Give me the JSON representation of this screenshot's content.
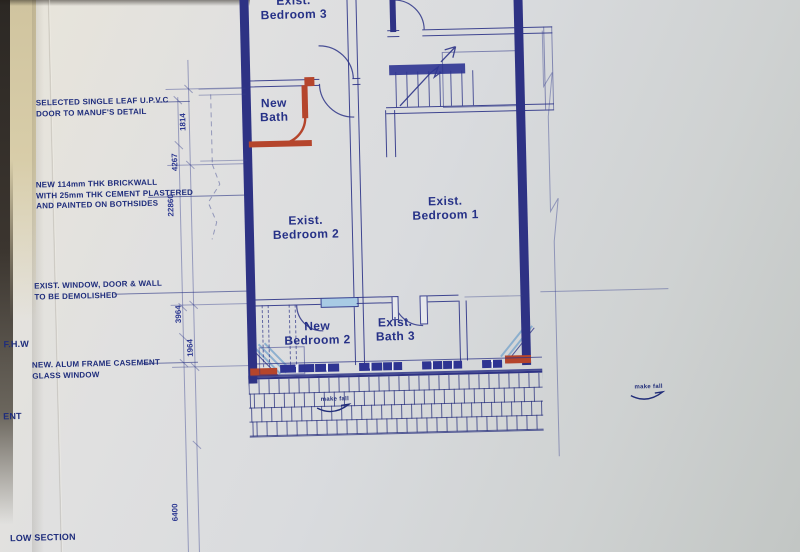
{
  "colors": {
    "ink": "#2b3187",
    "new_work": "#b5452c",
    "paper": "#d9dbdf",
    "glass": "#a8cbe4"
  },
  "annotations": {
    "upvc": {
      "line1": "SELECTED SINGLE LEAF U.P.V.C",
      "line2": "DOOR TO MANUF'S DETAIL"
    },
    "brickwall": {
      "line1": "NEW 114mm THK BRICKWALL",
      "line2": "WITH 25mm THK CEMENT PLASTERED",
      "line3": "AND PAINTED ON BOTHSIDES"
    },
    "demolish": {
      "line1": "EXIST. WINDOW, DOOR & WALL",
      "line2": "TO BE DEMOLISHED"
    },
    "fhw": "F.H.W",
    "casement": {
      "line1": "NEW. ALUM FRAME CASEMENT",
      "line2": "GLASS WINDOW"
    },
    "edge_partial": "ENT",
    "section": "LOW SECTION"
  },
  "rooms": [
    {
      "id": "exist-bedroom-3",
      "line1": "Exist.",
      "line2": "Bedroom 3"
    },
    {
      "id": "new-bath",
      "line1": "New",
      "line2": "Bath"
    },
    {
      "id": "exist-bedroom-2",
      "line1": "Exist.",
      "line2": "Bedroom 2"
    },
    {
      "id": "exist-bedroom-1",
      "line1": "Exist.",
      "line2": "Bedroom 1"
    },
    {
      "id": "new-bedroom-2",
      "line1": "New",
      "line2": "Bedroom 2"
    },
    {
      "id": "exist-bath-3",
      "line1": "Exist.",
      "line2": "Bath 3"
    }
  ],
  "dimensions": [
    "1814",
    "4267",
    "22860",
    "3964",
    "1964",
    "6400"
  ],
  "hatch_labels": [
    "make fall",
    "make fall"
  ]
}
